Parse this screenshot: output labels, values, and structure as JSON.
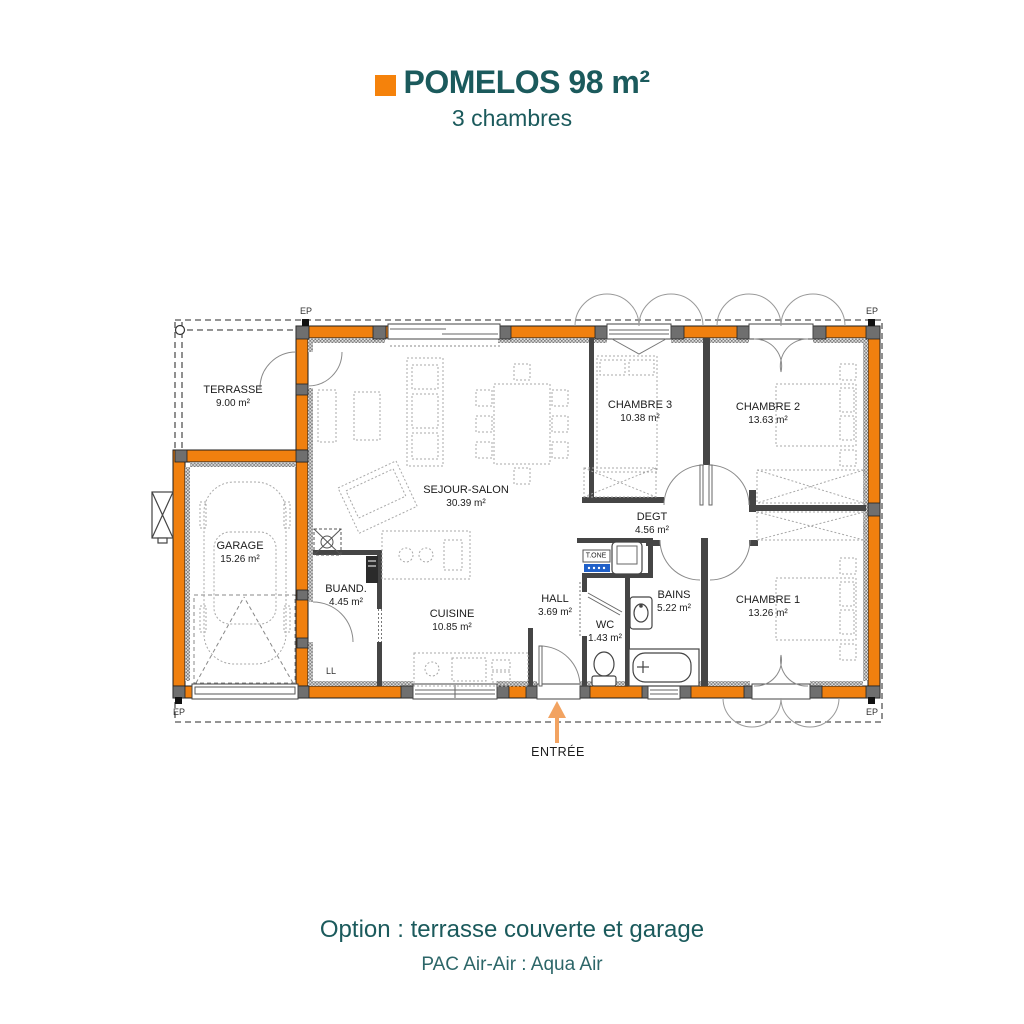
{
  "header": {
    "title": "POMELOS 98 m²",
    "subtitle": "3 chambres"
  },
  "rooms": [
    {
      "name": "TERRASSE",
      "area": "9.00 m²"
    },
    {
      "name": "GARAGE",
      "area": "15.26 m²"
    },
    {
      "name": "SEJOUR-SALON",
      "area": "30.39 m²"
    },
    {
      "name": "BUAND.",
      "area": "4.45 m²"
    },
    {
      "name": "CUISINE",
      "area": "10.85 m²"
    },
    {
      "name": "HALL",
      "area": "3.69 m²"
    },
    {
      "name": "WC",
      "area": "1.43 m²"
    },
    {
      "name": "BAINS",
      "area": "5.22 m²"
    },
    {
      "name": "DEGT",
      "area": "4.56 m²"
    },
    {
      "name": "CHAMBRE 3",
      "area": "10.38 m²"
    },
    {
      "name": "CHAMBRE 2",
      "area": "13.63 m²"
    },
    {
      "name": "CHAMBRE 1",
      "area": "13.26 m²"
    }
  ],
  "annotations": {
    "entrance": "ENTRÉE",
    "downspout": "EP",
    "washing_machine": "LL",
    "heat_pump_unit": "T.ONE"
  },
  "footer": {
    "option_line": "Option : terrasse couverte et garage",
    "pac_line": "PAC Air-Air : Aqua Air"
  },
  "colors": {
    "teal": "#1B5A5C",
    "accent_orange": "#F5820B",
    "wall_orange": "#F0800F",
    "arrow_orange": "#F2A361",
    "tone_blue": "#2060C8"
  }
}
